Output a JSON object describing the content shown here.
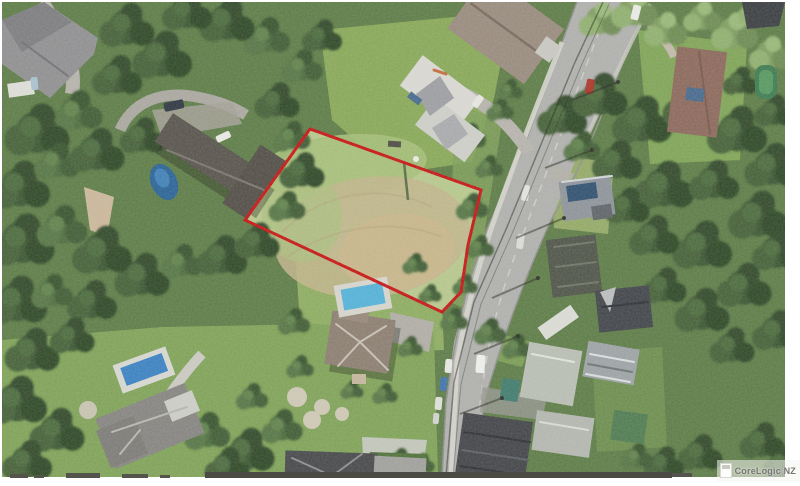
{
  "watermark": {
    "text": "CoreLogic NZ"
  },
  "boundary": {
    "color": "#c41414",
    "stroke_width": 3,
    "points": "308,127 479,188 466,243 459,290 440,310 243,218",
    "description": "red outline of vacant grass parcel in centre of aerial photo"
  },
  "scene": {
    "type": "aerial-photograph",
    "features": [
      "vacant dry-grass parcel outlined in red",
      "curved road running from top centre-right to bottom, with parked cars",
      "large gray-roof house with dark blue pool at left",
      "white hip-roof house and brown-roof house at top centre",
      "terracotta-roof house at top right with green pool cover",
      "house with brown hip roof and light blue pool below the parcel",
      "gray hip-roof house with blue pool at bottom left",
      "cluster of gray industrial roofs at bottom right",
      "dense native tree cover",
      "power pole shadows across road"
    ]
  }
}
